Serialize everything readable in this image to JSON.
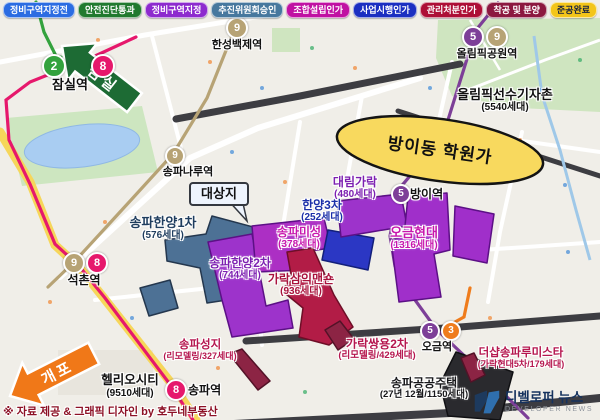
{
  "legend": {
    "items": [
      {
        "label": "정비구역지정전",
        "color": "#2b6ce2"
      },
      {
        "label": "안전진단통과",
        "color": "#217a2f"
      },
      {
        "label": "정비구역지정",
        "color": "#8d2bce"
      },
      {
        "label": "추진위원회승인",
        "color": "#47789e"
      },
      {
        "label": "조합설립인가",
        "color": "#c011a2"
      },
      {
        "label": "사업시행인가",
        "color": "#1b2fc1"
      },
      {
        "label": "관리처분인가",
        "color": "#ad0f36"
      },
      {
        "label": "착공 및 분양",
        "color": "#8c1840"
      },
      {
        "label": "준공완료",
        "color": "#f3c51a",
        "text_color": "#17223f"
      }
    ]
  },
  "map": {
    "target_label": "대상지",
    "highlight": {
      "label": "방이동 학원가",
      "fill": "#f8d95e",
      "border": "#141414"
    },
    "arrows": [
      {
        "label": "잠실",
        "color": "#1d6b34"
      },
      {
        "label": "개포",
        "color": "#f07818"
      }
    ],
    "stations": [
      {
        "name": "잠실역",
        "lines": [
          {
            "no": "2",
            "color": "#33a23d"
          },
          {
            "no": "8",
            "color": "#e6186c"
          }
        ]
      },
      {
        "name": "한성백제역",
        "lines": [
          {
            "no": "9",
            "color": "#b7a375"
          }
        ]
      },
      {
        "name": "올림픽공원역",
        "lines": [
          {
            "no": "5",
            "color": "#7d3f98"
          },
          {
            "no": "9",
            "color": "#b7a375"
          }
        ]
      },
      {
        "name": "송파나루역",
        "lines": [
          {
            "no": "9",
            "color": "#b7a375"
          }
        ]
      },
      {
        "name": "석촌역",
        "lines": [
          {
            "no": "9",
            "color": "#b7a375"
          },
          {
            "no": "8",
            "color": "#e6186c"
          }
        ]
      },
      {
        "name": "송파역",
        "lines": [
          {
            "no": "8",
            "color": "#e6186c"
          }
        ]
      },
      {
        "name": "방이역",
        "lines": [
          {
            "no": "5",
            "color": "#7d3f98"
          }
        ]
      },
      {
        "name": "오금역",
        "lines": [
          {
            "no": "5",
            "color": "#7d3f98"
          },
          {
            "no": "3",
            "color": "#ef7c1c"
          }
        ]
      }
    ],
    "complexes": [
      {
        "name": "송파한양1차",
        "detail": "(576세대)",
        "color": "#1f3d5e",
        "shape": "#4d7195"
      },
      {
        "name": "송파한양2차",
        "detail": "(744세대)",
        "color": "#7c1fb0",
        "shape": "#9d33cb"
      },
      {
        "name": "송파미성",
        "detail": "(378세대)",
        "color": "#c717ad",
        "shape": "#ac2fc4"
      },
      {
        "name": "한양3차",
        "detail": "(252세대)",
        "color": "#1b2fa8",
        "shape": "#2b37c4"
      },
      {
        "name": "대림가락",
        "detail": "(480세대)",
        "color": "#7c1fb0",
        "shape": "#9d33cb"
      },
      {
        "name": "오금현대",
        "detail": "(1316세대)",
        "color": "#c717ad",
        "shape": "#a02fca"
      },
      {
        "name": "가락삼익맨숀",
        "detail": "(936세대)",
        "color": "#a8123c",
        "shape": "#b21c46"
      },
      {
        "name": "송파성지",
        "detail": "(리모델링/327세대)",
        "color": "#b5164e",
        "shape": "#8c2444"
      },
      {
        "name": "가락쌍용2차",
        "detail": "(리모델링/429세대)",
        "color": "#b5164e",
        "shape": "#8c2444"
      },
      {
        "name": "송파공공주택",
        "detail": "(27년 12월/1150세대)",
        "color": "#17171a",
        "shape": "#2a2a2e"
      },
      {
        "name": "더샵송파루미스타",
        "detail": "(가락현대5차/179세대)",
        "color": "#b5164e",
        "shape": "#8c2444"
      },
      {
        "name": "올림픽선수기자촌",
        "detail": "(5540세대)",
        "color": "#111111"
      },
      {
        "name": "헬리오시티",
        "detail": "(9510세대)",
        "color": "#111111"
      }
    ],
    "footer_credit": "※ 자료 제공 & 그래픽 디자인 by 호두네부동산",
    "logo": {
      "kr": "디벨로퍼 뉴스",
      "en": "DEVELOPER NEWS"
    }
  }
}
